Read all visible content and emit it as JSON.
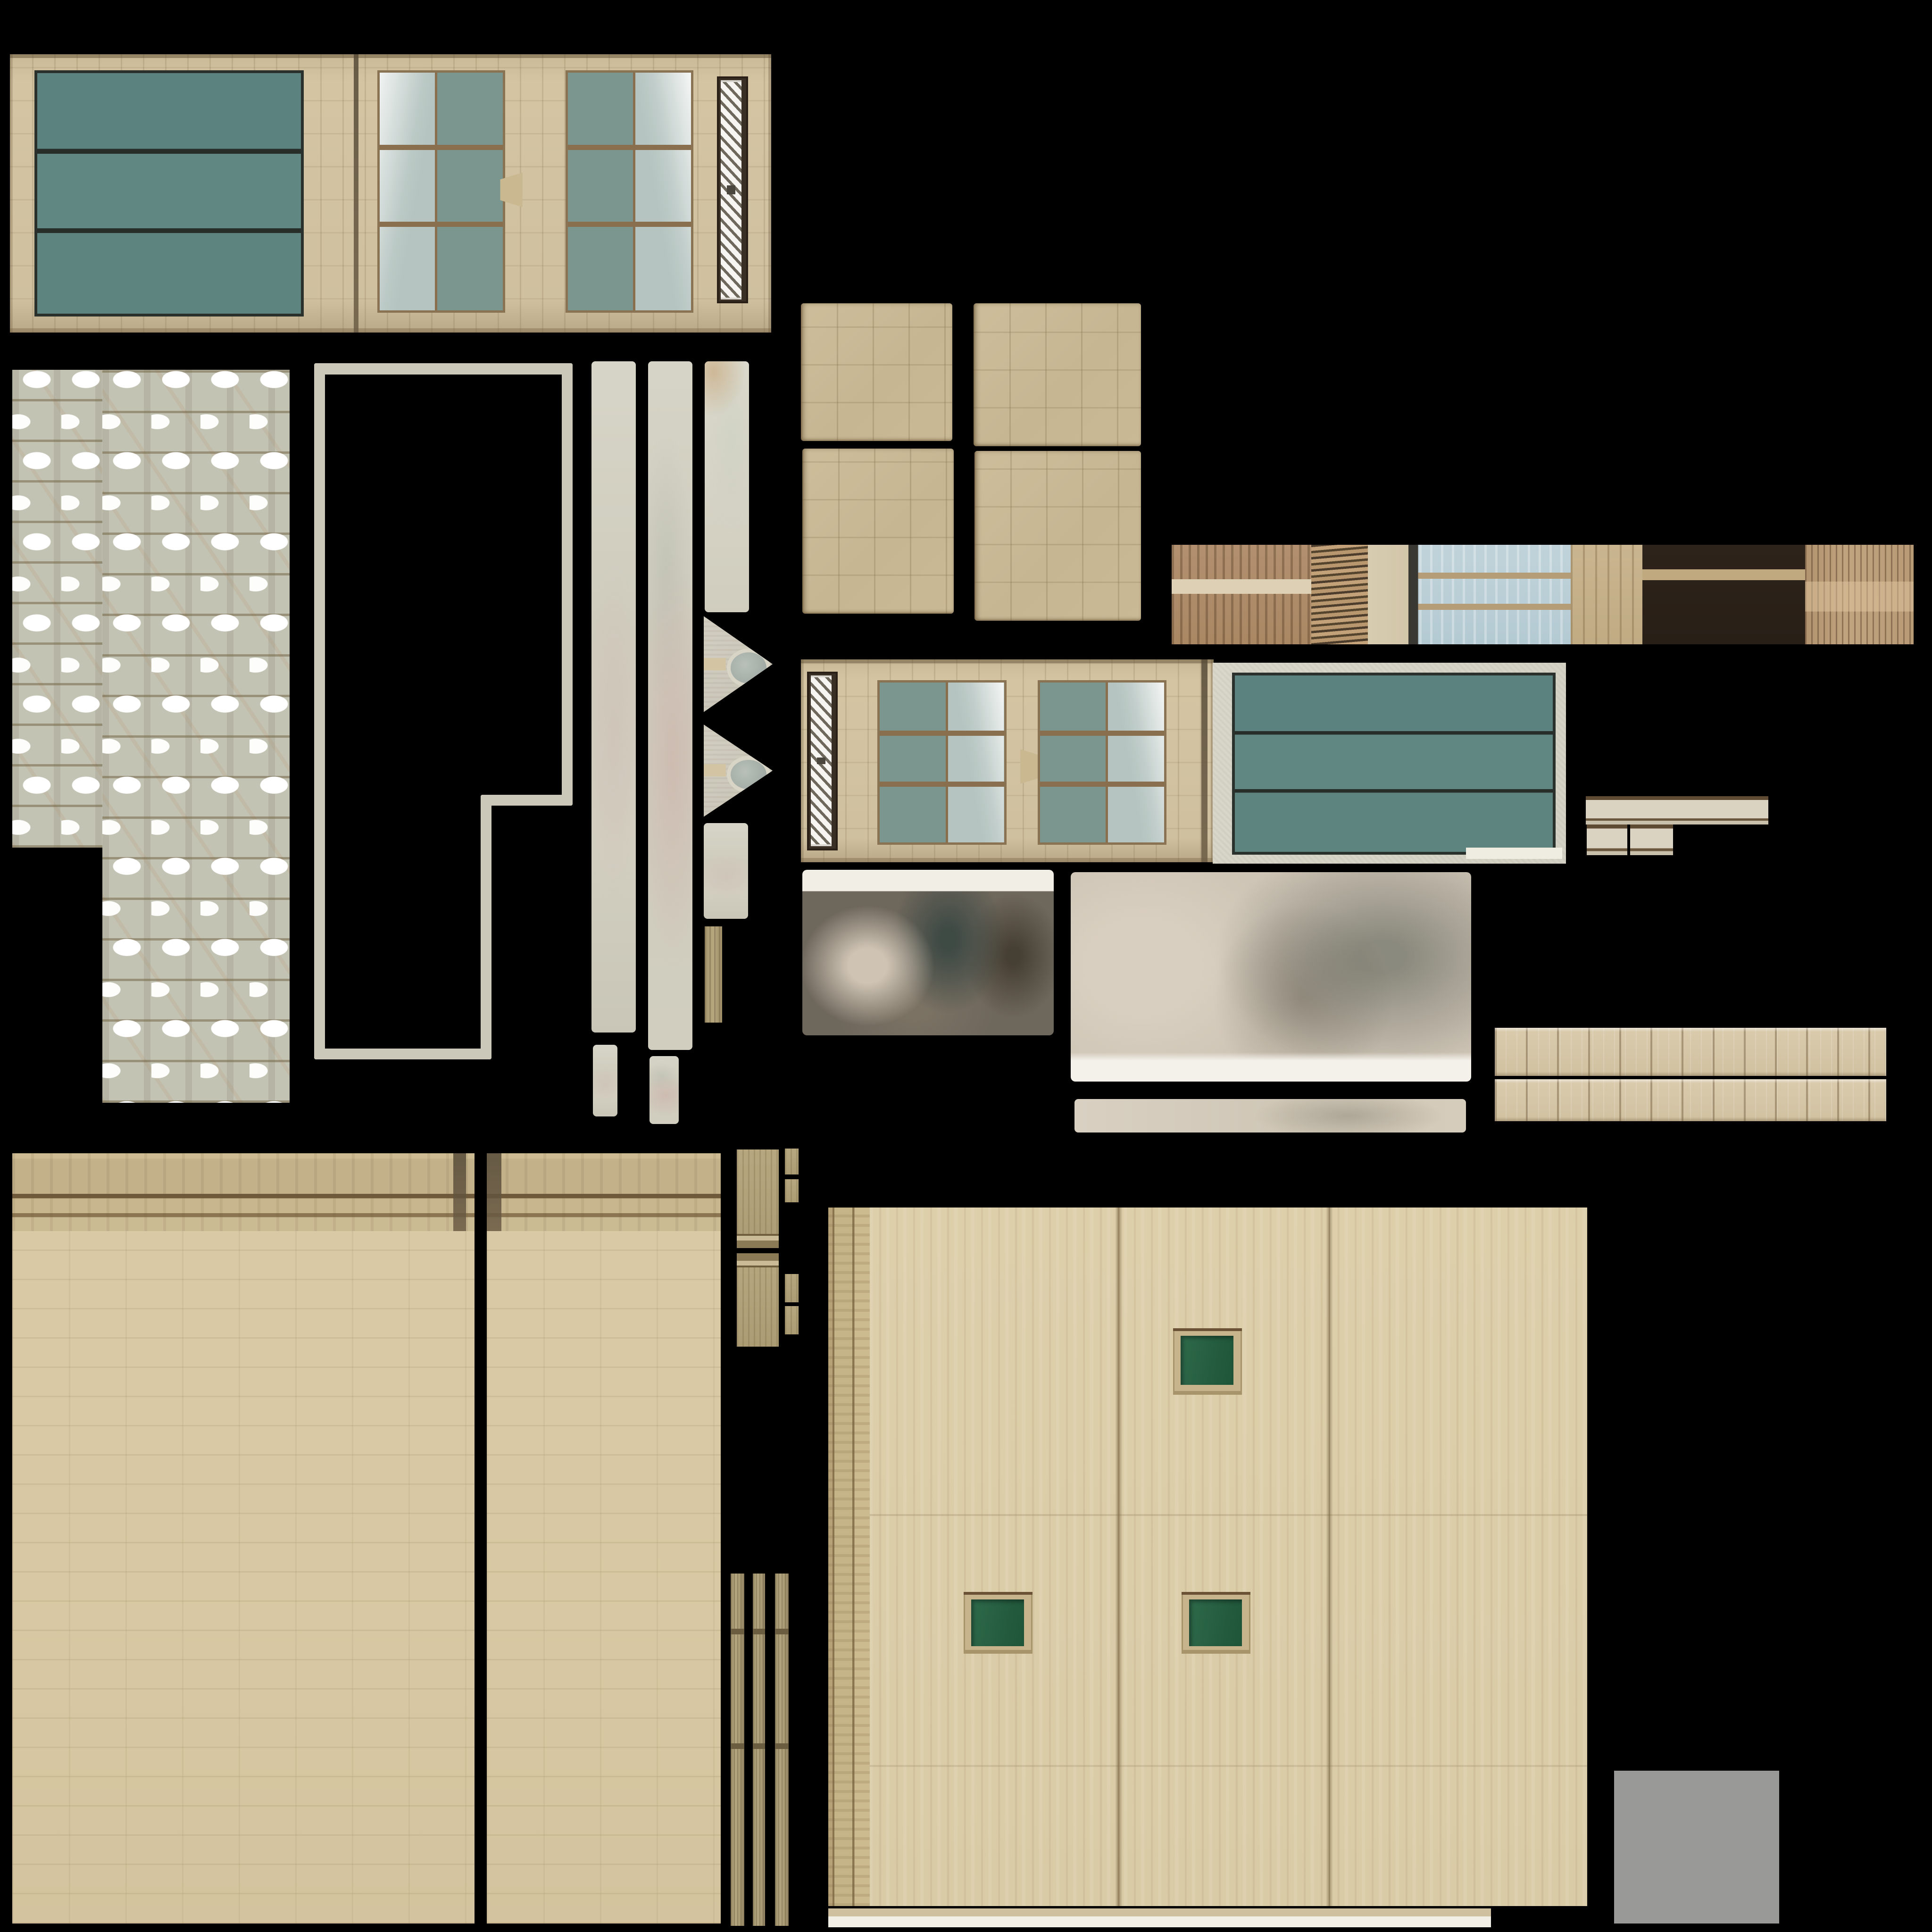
{
  "meta": {
    "kind": "texture-atlas",
    "subject": "building facade texture sheet",
    "background": "#000000"
  },
  "palette": {
    "background": "#000000",
    "beige_tile": "#cfc0a0",
    "teal_glass_panel": "#5e8783",
    "teal_window_glass": "#7a968f",
    "open_pane_glass": "#b5c4c0",
    "mullion_brown": "#8a6f4e",
    "grille_white": "#f6f5f1",
    "grille_recess": "#3a2f24",
    "roof_sage": "#c2c3b3",
    "roof_snow": "#ffffff",
    "piece_gray": "#cbc8b9",
    "stone_square": "#c9ba96",
    "ribbed_brown": "#b29070",
    "terracotta_wave": "#c3a179",
    "sky_window_blue": "#b8cdd4",
    "dark_brown": "#2b211a",
    "copper_rib": "#b89a76",
    "stone_frame_gray": "#d5d3c6",
    "cream_molding": "#dad3c1",
    "plank_beige": "#d5c6a7",
    "ashlar_wall": "#d8c8a4",
    "cornice_tan": "#c2b189",
    "tan_strip": "#ab9c74",
    "grain_wall": "#dbcda8",
    "pilaster_tan": "#c6b489",
    "window_green": "#266043",
    "window_frame_tan": "#c7b48c",
    "plain_gray_swatch": "#999997"
  },
  "regions": [
    {
      "name": "facade-a-base",
      "kind": "wallTile",
      "rect": [
        0.51,
        2.81,
        39.41,
        14.41
      ]
    },
    {
      "name": "facade-a-teal-panel",
      "kind": "tealPanel",
      "rect": [
        1.79,
        3.64,
        13.65,
        12.44
      ]
    },
    {
      "name": "facade-a-joint-line",
      "kind": "darkline",
      "rect": [
        18.3,
        2.81,
        0.26,
        14.41
      ]
    },
    {
      "name": "facade-a-window-1",
      "kind": "windowTeal left",
      "rect": [
        19.52,
        3.64,
        6.38,
        12.31
      ]
    },
    {
      "name": "facade-a-bracket",
      "kind": "bracketL",
      "rect": [
        25.89,
        8.93,
        1.15,
        1.79
      ]
    },
    {
      "name": "facade-a-window-2",
      "kind": "windowTeal right",
      "rect": [
        29.27,
        3.64,
        6.38,
        12.31
      ]
    },
    {
      "name": "facade-a-grille-recess",
      "kind": "grilleRecess",
      "rect": [
        37.12,
        3.95,
        1.59,
        11.74
      ]
    },
    {
      "name": "facade-a-grille",
      "kind": "grille",
      "rect": [
        37.31,
        4.15,
        1.08,
        11.35
      ]
    },
    {
      "name": "roof-shingles-left",
      "kind": "roof",
      "rect": [
        0.64,
        19.13,
        4.66,
        24.74
      ]
    },
    {
      "name": "roof-shingles-right",
      "kind": "roof",
      "rect": [
        5.29,
        19.13,
        9.69,
        37.95
      ]
    },
    {
      "name": "outline-left",
      "kind": "bar",
      "rect": [
        16.26,
        18.81,
        0.57,
        36.03
      ]
    },
    {
      "name": "outline-top",
      "kind": "bar",
      "rect": [
        16.26,
        18.81,
        13.39,
        0.57
      ]
    },
    {
      "name": "outline-right-upper",
      "kind": "bar",
      "rect": [
        29.08,
        18.81,
        0.57,
        22.89
      ]
    },
    {
      "name": "outline-jog",
      "kind": "bar",
      "rect": [
        24.87,
        41.13,
        4.78,
        0.57
      ]
    },
    {
      "name": "outline-right-lower",
      "kind": "bar",
      "rect": [
        24.87,
        41.13,
        0.57,
        13.71
      ]
    },
    {
      "name": "outline-bottom",
      "kind": "bar",
      "rect": [
        16.26,
        54.27,
        9.18,
        0.57
      ]
    },
    {
      "name": "strip-a",
      "kind": "softStrip",
      "rect": [
        30.61,
        18.69,
        2.3,
        34.76
      ]
    },
    {
      "name": "strip-a-tail",
      "kind": "softStrip",
      "rect": [
        30.68,
        54.08,
        1.28,
        3.7
      ]
    },
    {
      "name": "strip-b",
      "kind": "softStrip pink",
      "rect": [
        33.55,
        18.69,
        2.3,
        35.65
      ]
    },
    {
      "name": "strip-b-tail",
      "kind": "softStrip pink",
      "rect": [
        33.61,
        54.66,
        1.53,
        3.51
      ]
    },
    {
      "name": "strip-c",
      "kind": "softStrip light",
      "rect": [
        36.48,
        18.69,
        2.3,
        13.01
      ]
    },
    {
      "name": "triangle-piece-1",
      "kind": "triangle",
      "rect": [
        36.42,
        31.89,
        3.57,
        4.97
      ]
    },
    {
      "name": "triangle-1-tab",
      "kind": "tab",
      "rect": [
        36.42,
        34.06,
        1.15,
        0.64
      ]
    },
    {
      "name": "triangle-piece-2",
      "kind": "triangle",
      "rect": [
        36.42,
        37.5,
        3.57,
        4.78
      ]
    },
    {
      "name": "triangle-2-tab",
      "kind": "tab",
      "rect": [
        36.42,
        39.54,
        1.15,
        0.64
      ]
    },
    {
      "name": "piece-below-triangles",
      "kind": "softStrip",
      "rect": [
        36.42,
        42.6,
        2.3,
        4.97
      ]
    },
    {
      "name": "narrow-tan-strip",
      "kind": "tanStrip",
      "rect": [
        36.48,
        47.96,
        0.89,
        4.97
      ]
    },
    {
      "name": "stone-square-tl",
      "kind": "stoneSquare",
      "rect": [
        41.45,
        15.69,
        7.84,
        7.14
      ]
    },
    {
      "name": "stone-square-tr",
      "kind": "stoneSquare",
      "rect": [
        50.38,
        15.69,
        8.67,
        7.4
      ]
    },
    {
      "name": "stone-square-bl",
      "kind": "stoneSquare",
      "rect": [
        41.52,
        23.21,
        7.84,
        8.55
      ]
    },
    {
      "name": "stone-square-br",
      "kind": "stoneSquare",
      "rect": [
        50.45,
        23.34,
        8.61,
        8.8
      ]
    },
    {
      "name": "strip-ribbed-brown",
      "kind": "ribbedBrown",
      "rect": [
        60.65,
        28.19,
        7.21,
        5.17
      ]
    },
    {
      "name": "strip-cream-band",
      "kind": "creamBand",
      "rect": [
        60.65,
        29.97,
        7.21,
        0.77
      ]
    },
    {
      "name": "strip-roof-wave",
      "kind": "waveTile",
      "rect": [
        67.86,
        28.19,
        2.93,
        5.17
      ]
    },
    {
      "name": "strip-light-column",
      "kind": "lightCol",
      "rect": [
        70.79,
        28.19,
        2.1,
        5.17
      ]
    },
    {
      "name": "strip-blue-window",
      "kind": "blueWindow",
      "rect": [
        72.9,
        28.19,
        8.42,
        5.17
      ]
    },
    {
      "name": "strip-tan-striped",
      "kind": "tanStriped",
      "rect": [
        81.31,
        28.19,
        3.7,
        5.17
      ]
    },
    {
      "name": "strip-dark-brown",
      "kind": "darkBrown",
      "rect": [
        85.01,
        28.19,
        8.42,
        5.17
      ]
    },
    {
      "name": "strip-dark-brown-band",
      "kind": "tanBand",
      "rect": [
        85.01,
        29.46,
        8.42,
        0.57
      ]
    },
    {
      "name": "strip-ribbed-copper",
      "kind": "ribbedCopper",
      "rect": [
        93.43,
        28.19,
        5.61,
        5.17
      ]
    },
    {
      "name": "facade-b-base",
      "kind": "wallTile",
      "rect": [
        41.45,
        34.12,
        21.36,
        10.52
      ]
    },
    {
      "name": "facade-b-stone-frame",
      "kind": "stoneFrame",
      "rect": [
        62.76,
        34.31,
        18.3,
        10.4
      ]
    },
    {
      "name": "facade-b-teal-panel",
      "kind": "tealPanel",
      "rect": [
        63.78,
        34.82,
        16.45,
        9.12
      ]
    },
    {
      "name": "facade-b-white-sliver",
      "kind": "white",
      "rect": [
        75.89,
        43.88,
        4.97,
        0.57
      ]
    },
    {
      "name": "facade-b-grille-recess",
      "kind": "grilleRecess",
      "rect": [
        41.77,
        34.76,
        1.59,
        9.25
      ]
    },
    {
      "name": "facade-b-grille",
      "kind": "grille",
      "rect": [
        41.96,
        34.95,
        1.08,
        8.86
      ]
    },
    {
      "name": "facade-b-window-1",
      "kind": "windowTeal right",
      "rect": [
        45.41,
        35.2,
        6.44,
        8.29
      ]
    },
    {
      "name": "facade-b-bracket",
      "kind": "bracketR",
      "rect": [
        52.81,
        38.78,
        1.15,
        1.79
      ]
    },
    {
      "name": "facade-b-window-2",
      "kind": "windowTeal right",
      "rect": [
        53.7,
        35.2,
        6.44,
        8.29
      ]
    },
    {
      "name": "facade-b-joint-line",
      "kind": "darkline",
      "rect": [
        62.18,
        34.12,
        0.32,
        10.52
      ]
    },
    {
      "name": "lod-texture-dark",
      "kind": "blurDark",
      "rect": [
        41.52,
        45.03,
        13.01,
        8.55
      ]
    },
    {
      "name": "lod-texture-light",
      "kind": "blurLight",
      "rect": [
        55.42,
        45.15,
        20.73,
        10.84
      ]
    },
    {
      "name": "lod-texture-strip",
      "kind": "blurStrip",
      "rect": [
        55.61,
        56.89,
        20.28,
        1.72
      ]
    },
    {
      "name": "molding-bar-long",
      "kind": "molding",
      "rect": [
        82.08,
        41.2,
        9.44,
        1.47
      ]
    },
    {
      "name": "molding-piece-a",
      "kind": "molding",
      "rect": [
        82.14,
        42.67,
        2.1,
        1.59
      ]
    },
    {
      "name": "molding-piece-b",
      "kind": "molding",
      "rect": [
        84.37,
        42.67,
        2.23,
        1.59
      ]
    },
    {
      "name": "plank-bar-upper",
      "kind": "plankBar",
      "rect": [
        77.36,
        53.19,
        20.28,
        2.49
      ]
    },
    {
      "name": "plank-bar-lower",
      "kind": "plankBar",
      "rect": [
        77.36,
        55.87,
        20.28,
        2.17
      ]
    },
    {
      "name": "ashlar-wall-left",
      "kind": "ashlar",
      "rect": [
        0.64,
        59.69,
        23.92,
        39.86
      ]
    },
    {
      "name": "ashlar-wall-left-cornice",
      "kind": "cornice",
      "rect": [
        0.64,
        59.69,
        23.92,
        4.02
      ]
    },
    {
      "name": "ashlar-left-pilaster-cap",
      "kind": "darkline",
      "rect": [
        23.47,
        59.69,
        0.64,
        4.02
      ]
    },
    {
      "name": "ashlar-wall-right",
      "kind": "ashlar",
      "rect": [
        25.19,
        59.69,
        12.12,
        39.86
      ]
    },
    {
      "name": "ashlar-wall-right-cornice",
      "kind": "cornice",
      "rect": [
        25.19,
        59.69,
        12.12,
        4.02
      ]
    },
    {
      "name": "ashlar-right-pilaster-cap",
      "kind": "darkline",
      "rect": [
        25.19,
        59.69,
        0.77,
        4.02
      ]
    },
    {
      "name": "tan-block-1",
      "kind": "tanBlock molB",
      "rect": [
        38.14,
        59.5,
        2.17,
        5.1
      ]
    },
    {
      "name": "tan-tiny-a",
      "kind": "tanBlock",
      "rect": [
        40.63,
        59.44,
        0.7,
        1.34
      ]
    },
    {
      "name": "tan-tiny-b",
      "kind": "tanBlock",
      "rect": [
        40.63,
        61.03,
        0.7,
        1.21
      ]
    },
    {
      "name": "tan-block-2",
      "kind": "tanBlock molT",
      "rect": [
        38.14,
        64.86,
        2.17,
        4.85
      ]
    },
    {
      "name": "tan-tiny-c",
      "kind": "tanBlock",
      "rect": [
        40.63,
        65.94,
        0.7,
        1.47
      ]
    },
    {
      "name": "tan-tiny-d",
      "kind": "tanBlock",
      "rect": [
        40.63,
        67.6,
        0.7,
        1.47
      ]
    },
    {
      "name": "thin-strip-1",
      "kind": "thinStrip",
      "rect": [
        37.82,
        81.44,
        0.7,
        18.24
      ]
    },
    {
      "name": "thin-strip-2",
      "kind": "thinStrip",
      "rect": [
        38.97,
        81.44,
        0.64,
        18.24
      ]
    },
    {
      "name": "thin-strip-3",
      "kind": "thinStrip",
      "rect": [
        40.11,
        81.44,
        0.7,
        18.24
      ]
    },
    {
      "name": "grain-wall",
      "kind": "grainWall",
      "rect": [
        42.86,
        62.5,
        39.29,
        36.16
      ]
    },
    {
      "name": "grain-wall-pilaster",
      "kind": "pilaster",
      "rect": [
        42.86,
        62.5,
        2.17,
        36.16
      ]
    },
    {
      "name": "grain-wall-seam-1",
      "kind": "seam",
      "rect": [
        57.72,
        62.5,
        0.38,
        36.16
      ]
    },
    {
      "name": "grain-wall-seam-2",
      "kind": "seam",
      "rect": [
        68.62,
        62.5,
        0.38,
        36.16
      ]
    },
    {
      "name": "green-window-upper-frame",
      "kind": "winFrame",
      "rect": [
        60.71,
        68.75,
        3.57,
        3.44
      ]
    },
    {
      "name": "green-window-upper-glass",
      "kind": "greenGlass",
      "rect": [
        61.1,
        69.13,
        2.74,
        2.55
      ]
    },
    {
      "name": "green-window-lower-left-frame",
      "kind": "winFrame",
      "rect": [
        49.87,
        82.4,
        3.57,
        3.19
      ]
    },
    {
      "name": "green-window-lower-left-glass",
      "kind": "greenGlass",
      "rect": [
        50.26,
        82.78,
        2.74,
        2.42
      ]
    },
    {
      "name": "green-window-lower-right-frame",
      "kind": "winFrame",
      "rect": [
        61.16,
        82.4,
        3.57,
        3.19
      ]
    },
    {
      "name": "green-window-lower-right-glass",
      "kind": "greenGlass",
      "rect": [
        61.54,
        82.78,
        2.74,
        2.42
      ]
    },
    {
      "name": "wall-base-strip",
      "kind": "baseStrip",
      "rect": [
        42.86,
        98.79,
        34.31,
        0.96
      ]
    },
    {
      "name": "gray-swatch",
      "kind": "plainGray",
      "rect": [
        83.55,
        91.65,
        8.55,
        7.91
      ]
    }
  ]
}
